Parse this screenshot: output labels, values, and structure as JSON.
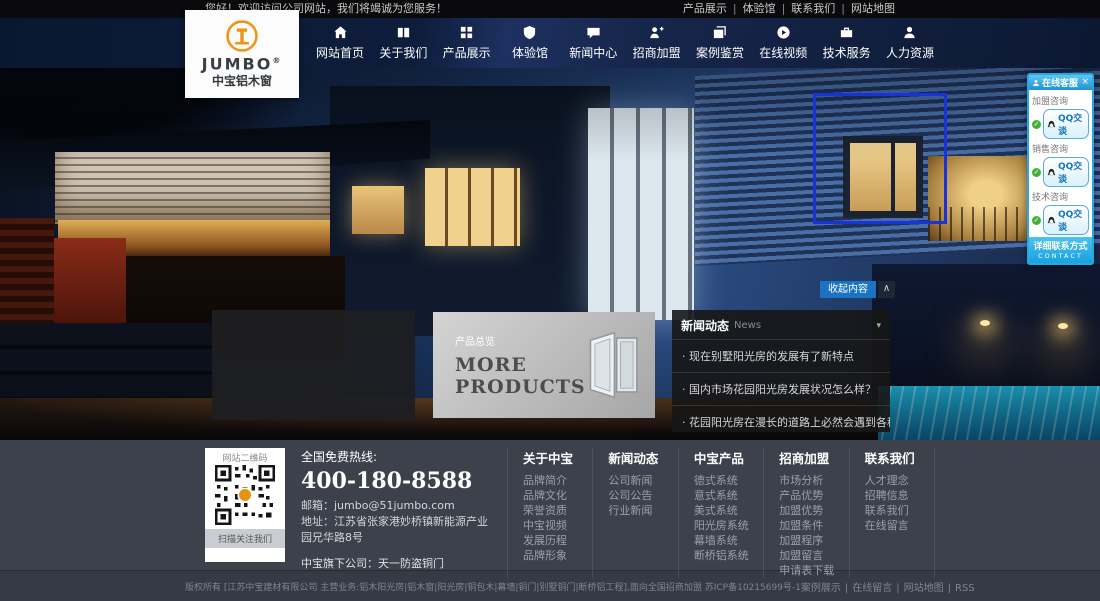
{
  "topbar": {
    "welcome": "您好！欢迎访问公司网站，我们将竭诚为您服务！",
    "separator": "|",
    "links": [
      "产品展示",
      "体验馆",
      "联系我们",
      "网站地图"
    ]
  },
  "logo": {
    "brand": "JUMBO",
    "reg": "®",
    "subtitle": "中宝铝木窗"
  },
  "nav": {
    "items": [
      {
        "label": "网站首页",
        "icon": "home-icon"
      },
      {
        "label": "关于我们",
        "icon": "book-icon"
      },
      {
        "label": "产品展示",
        "icon": "grid-icon"
      },
      {
        "label": "体验馆",
        "icon": "shield-icon"
      },
      {
        "label": "新闻中心",
        "icon": "chat-icon"
      },
      {
        "label": "招商加盟",
        "icon": "user-plus-icon"
      },
      {
        "label": "案例鉴赏",
        "icon": "photos-icon"
      },
      {
        "label": "在线视频",
        "icon": "play-icon"
      },
      {
        "label": "技术服务",
        "icon": "briefcase-icon"
      },
      {
        "label": "人力资源",
        "icon": "user-icon"
      }
    ]
  },
  "hero": {
    "collapse_button": "收起内容",
    "collapse_arrow": "∧",
    "products_panel": {
      "label": "产品总览",
      "line1": "MORE",
      "line2": "PRODUCTS"
    },
    "news": {
      "title": "新闻动态",
      "title_en": "News",
      "caret": "▾",
      "items": [
        "· 现在别墅阳光房的发展有了新特点",
        "· 国内市场花园阳光房发展状况怎么样？",
        "· 花园阳光房在漫长的道路上必然会遇到各种挑战"
      ]
    }
  },
  "qq_panel": {
    "title": "在线客服",
    "close": "×",
    "check": "✓",
    "groups": [
      {
        "label": "加盟咨询",
        "button": "QQ交谈"
      },
      {
        "label": "销售咨询",
        "button": "QQ交谈"
      },
      {
        "label": "技术咨询",
        "button": "QQ交谈"
      }
    ],
    "footer": "详细联系方式",
    "footer_en": "CONTACT"
  },
  "footer": {
    "qr": {
      "title": "网站二维码",
      "caption": "扫描关注我们"
    },
    "hotline_label": "全国免费热线:",
    "hotline_number": "400-180-8588",
    "email": "邮箱：jumbo@51jumbo.com",
    "address": "地址：江苏省张家港妙桥镇新能源产业园兄华路8号",
    "subsidiary": "中宝旗下公司：天一防盗铜门",
    "columns": [
      {
        "title": "关于中宝",
        "links": [
          "品牌简介",
          "品牌文化",
          "荣誉资质",
          "中宝视频",
          "发展历程",
          "品牌形象"
        ]
      },
      {
        "title": "新闻动态",
        "links": [
          "公司新闻",
          "公司公告",
          "行业新闻"
        ]
      },
      {
        "title": "中宝产品",
        "links": [
          "德式系统",
          "意式系统",
          "美式系统",
          "阳光房系统",
          "幕墙系统",
          "断桥铝系统"
        ]
      },
      {
        "title": "招商加盟",
        "links": [
          "市场分析",
          "产品优势",
          "加盟优势",
          "加盟条件",
          "加盟程序",
          "加盟留言",
          "申请表下载"
        ]
      },
      {
        "title": "联系我们",
        "links": [
          "人才理念",
          "招聘信息",
          "联系我们",
          "在线留言"
        ]
      }
    ]
  },
  "bottombar": {
    "copyright": "版权所有 [江苏中宝建材有限公司 主营业务:铝木阳光房|铝木窗|阳光房|铜包木|幕墙|铜门|别墅铜门|断桥铝工程],面向全国招商加盟 苏ICP备10215699号-1",
    "separator": "|",
    "links": [
      "案例展示",
      "在线留言",
      "网站地图",
      "RSS"
    ]
  },
  "colors": {
    "accent_blue": "#1b74c2",
    "qq_panel_blue": "#2aa7e0",
    "nav_bg": "#0d1b35",
    "footer_bg": "#3d414b",
    "logo_orange": "#e8920f",
    "highlight_box_blue": "#1733d9"
  }
}
